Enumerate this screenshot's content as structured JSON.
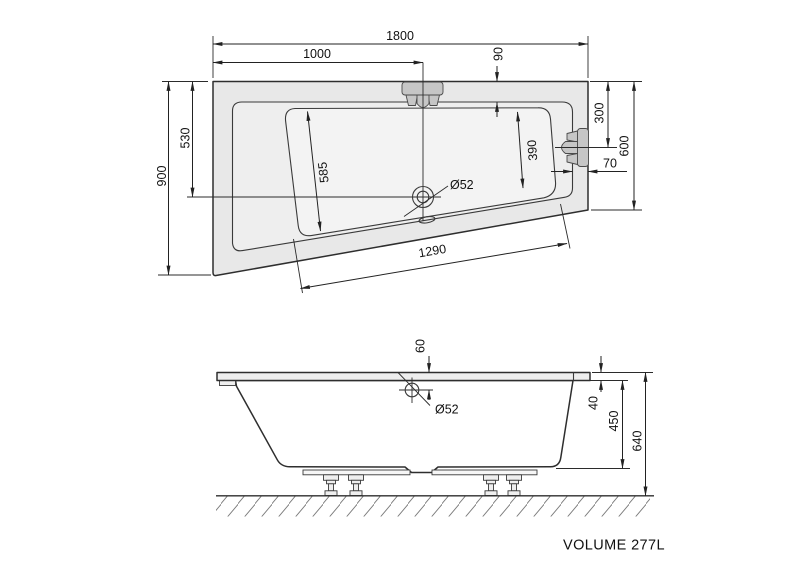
{
  "drawing_title": "VOLUME 277L",
  "top_view": {
    "overall_length": "1800",
    "drain_offset_x": "1000",
    "rim_width_top": "90",
    "overall_width_left": "900",
    "drain_offset_y": "530",
    "basin_left_edge": "585",
    "basin_right_edge": "390",
    "bracket_offset": "300",
    "overall_width_right": "600",
    "rim_width_right": "70",
    "drain_diameter": "Ø52",
    "basin_diagonal_edge": "1290"
  },
  "side_view": {
    "drain_depth_offset": "60",
    "drain_diameter": "Ø52",
    "rim_thickness": "40",
    "body_height": "450",
    "overall_height": "640"
  },
  "colors": {
    "line": "#2e2e2e",
    "dimension": "#222222",
    "tub_fill": "#e8e8e8",
    "basin_fill": "#f3f3f3",
    "bracket_fill": "#c6c6c6",
    "background": "#ffffff"
  }
}
